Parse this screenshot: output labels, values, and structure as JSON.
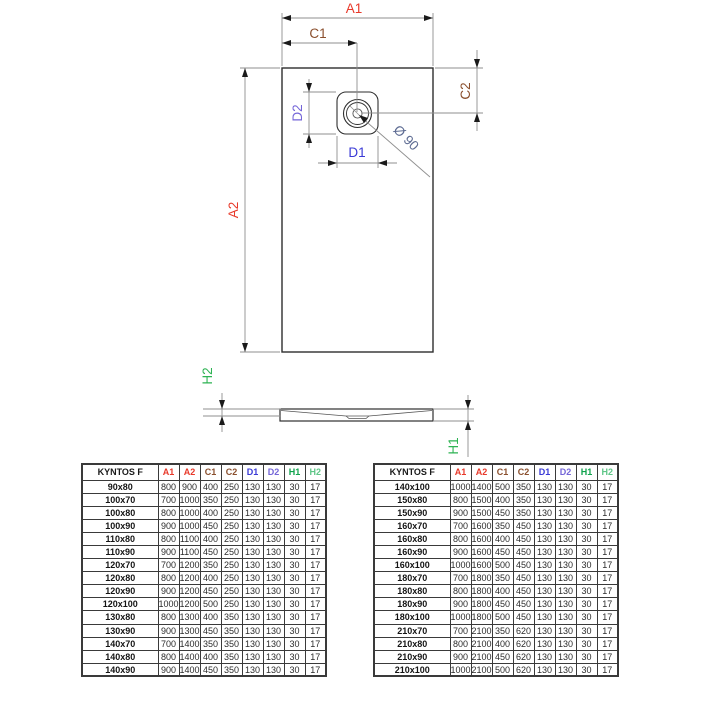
{
  "drawing": {
    "a1": "A1",
    "a2": "A2",
    "c1": "C1",
    "c2": "C2",
    "d1": "D1",
    "d2": "D2",
    "h1": "H1",
    "h2": "H2",
    "diameter": "Ø 90"
  },
  "colors": {
    "dim_a": "#e8392a",
    "dim_c": "#8a4f2d",
    "dim_d1": "#3a3ad6",
    "dim_d2": "#7465d8",
    "dim_h": "#2eb353",
    "dim_diameter": "#5d6b92"
  },
  "tables": {
    "header": [
      "KYNTOS F",
      "A1",
      "A2",
      "C1",
      "C2",
      "D1",
      "D2",
      "H1",
      "H2"
    ],
    "header_colors": [
      "#1a1a1a",
      "#e8392a",
      "#e8392a",
      "#8a4f2d",
      "#8a4f2d",
      "#3a3ad6",
      "#7465d8",
      "#0fa24c",
      "#5fc687"
    ],
    "left_rows": [
      [
        "90x80",
        "800",
        "900",
        "400",
        "250",
        "130",
        "130",
        "30",
        "17"
      ],
      [
        "100x70",
        "700",
        "1000",
        "350",
        "250",
        "130",
        "130",
        "30",
        "17"
      ],
      [
        "100x80",
        "800",
        "1000",
        "400",
        "250",
        "130",
        "130",
        "30",
        "17"
      ],
      [
        "100x90",
        "900",
        "1000",
        "450",
        "250",
        "130",
        "130",
        "30",
        "17"
      ],
      [
        "110x80",
        "800",
        "1100",
        "400",
        "250",
        "130",
        "130",
        "30",
        "17"
      ],
      [
        "110x90",
        "900",
        "1100",
        "450",
        "250",
        "130",
        "130",
        "30",
        "17"
      ],
      [
        "120x70",
        "700",
        "1200",
        "350",
        "250",
        "130",
        "130",
        "30",
        "17"
      ],
      [
        "120x80",
        "800",
        "1200",
        "400",
        "250",
        "130",
        "130",
        "30",
        "17"
      ],
      [
        "120x90",
        "900",
        "1200",
        "450",
        "250",
        "130",
        "130",
        "30",
        "17"
      ],
      [
        "120x100",
        "1000",
        "1200",
        "500",
        "250",
        "130",
        "130",
        "30",
        "17"
      ],
      [
        "130x80",
        "800",
        "1300",
        "400",
        "350",
        "130",
        "130",
        "30",
        "17"
      ],
      [
        "130x90",
        "900",
        "1300",
        "450",
        "350",
        "130",
        "130",
        "30",
        "17"
      ],
      [
        "140x70",
        "700",
        "1400",
        "350",
        "350",
        "130",
        "130",
        "30",
        "17"
      ],
      [
        "140x80",
        "800",
        "1400",
        "400",
        "350",
        "130",
        "130",
        "30",
        "17"
      ],
      [
        "140x90",
        "900",
        "1400",
        "450",
        "350",
        "130",
        "130",
        "30",
        "17"
      ]
    ],
    "right_rows": [
      [
        "140x100",
        "1000",
        "1400",
        "500",
        "350",
        "130",
        "130",
        "30",
        "17"
      ],
      [
        "150x80",
        "800",
        "1500",
        "400",
        "350",
        "130",
        "130",
        "30",
        "17"
      ],
      [
        "150x90",
        "900",
        "1500",
        "450",
        "350",
        "130",
        "130",
        "30",
        "17"
      ],
      [
        "160x70",
        "700",
        "1600",
        "350",
        "450",
        "130",
        "130",
        "30",
        "17"
      ],
      [
        "160x80",
        "800",
        "1600",
        "400",
        "450",
        "130",
        "130",
        "30",
        "17"
      ],
      [
        "160x90",
        "900",
        "1600",
        "450",
        "450",
        "130",
        "130",
        "30",
        "17"
      ],
      [
        "160x100",
        "1000",
        "1600",
        "500",
        "450",
        "130",
        "130",
        "30",
        "17"
      ],
      [
        "180x70",
        "700",
        "1800",
        "350",
        "450",
        "130",
        "130",
        "30",
        "17"
      ],
      [
        "180x80",
        "800",
        "1800",
        "400",
        "450",
        "130",
        "130",
        "30",
        "17"
      ],
      [
        "180x90",
        "900",
        "1800",
        "450",
        "450",
        "130",
        "130",
        "30",
        "17"
      ],
      [
        "180x100",
        "1000",
        "1800",
        "500",
        "450",
        "130",
        "130",
        "30",
        "17"
      ],
      [
        "210x70",
        "700",
        "2100",
        "350",
        "620",
        "130",
        "130",
        "30",
        "17"
      ],
      [
        "210x80",
        "800",
        "2100",
        "400",
        "620",
        "130",
        "130",
        "30",
        "17"
      ],
      [
        "210x90",
        "900",
        "2100",
        "450",
        "620",
        "130",
        "130",
        "30",
        "17"
      ],
      [
        "210x100",
        "1000",
        "2100",
        "500",
        "620",
        "130",
        "130",
        "30",
        "17"
      ]
    ]
  }
}
